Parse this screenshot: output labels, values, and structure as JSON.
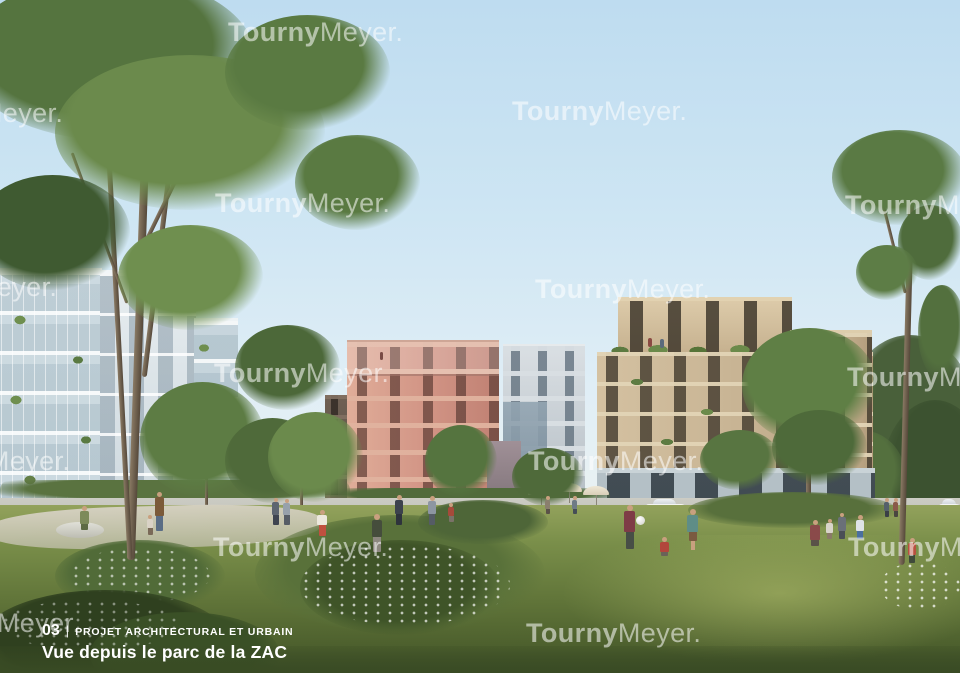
{
  "watermark": {
    "brand_bold": "Tourny",
    "brand_light": "Meyer."
  },
  "watermarks": [
    {
      "x": 228,
      "y": 17
    },
    {
      "x": -112,
      "y": 98
    },
    {
      "x": 512,
      "y": 96
    },
    {
      "x": 215,
      "y": 188
    },
    {
      "x": 845,
      "y": 190
    },
    {
      "x": -118,
      "y": 272
    },
    {
      "x": 535,
      "y": 274
    },
    {
      "x": 214,
      "y": 358
    },
    {
      "x": 847,
      "y": 362
    },
    {
      "x": -105,
      "y": 446
    },
    {
      "x": 528,
      "y": 446
    },
    {
      "x": 213,
      "y": 532
    },
    {
      "x": 848,
      "y": 532
    },
    {
      "x": -95,
      "y": 608
    },
    {
      "x": 526,
      "y": 618
    }
  ],
  "caption": {
    "number": "03",
    "separator": "|",
    "category": "PROJET ARCHITECTURAL ET URBAIN",
    "title": "Vue depuis le parc de la ZAC"
  },
  "palette": {
    "sky_top": "#bedcf0",
    "sky_horizon": "#e9f2f5",
    "grass_light": "#8a9a56",
    "grass_dark": "#46572a",
    "building_left": "#dfe8ec",
    "building_pink": "#d19384",
    "building_gray": "#c9d1d7",
    "building_beige": "#c7b393",
    "colonnade_stone": "#b4c0c6",
    "foliage_mid": "#5a7a42",
    "watermark_color": "#ffffff",
    "caption_color": "#ffffff"
  }
}
